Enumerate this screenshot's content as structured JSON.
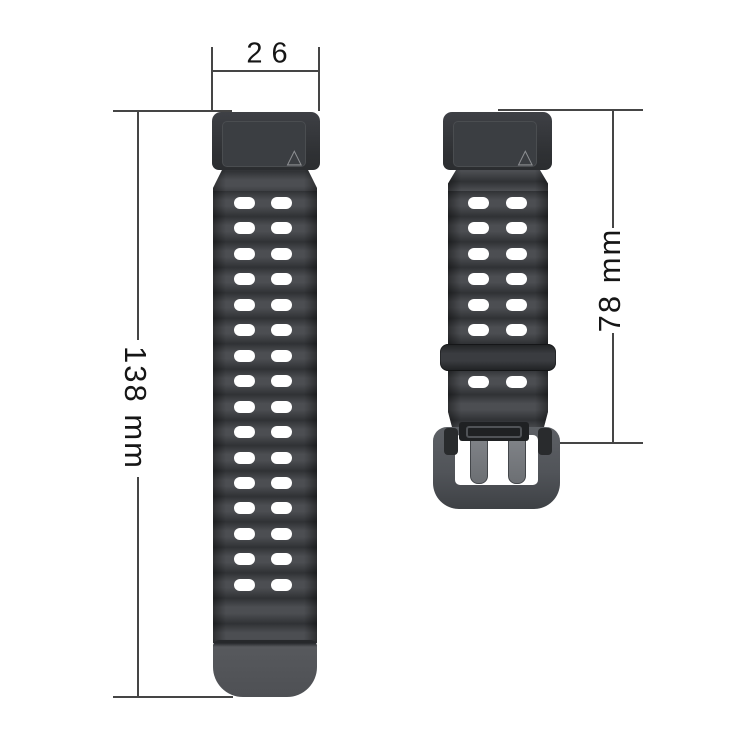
{
  "diagram": {
    "subject": "watch-strap-dimension-diagram",
    "dimensions": {
      "width": {
        "label": "26"
      },
      "long_strap_length": {
        "label": "138 mm"
      },
      "short_strap_length": {
        "label": "78 mm"
      }
    },
    "long_strap": {
      "hole_rows": 16,
      "hole_cols": 2
    },
    "short_strap": {
      "hole_rows_above_keeper": 6,
      "hole_rows_below_keeper": 1,
      "hole_cols": 2
    },
    "icons": {
      "triangle_mark": "△"
    },
    "colors": {
      "background": "#ffffff",
      "strap_ridge_dark": "#303235",
      "strap_ridge_light": "#4c4e52",
      "connector": "#323438",
      "strap_tip": "#515357",
      "keeper": "#2c2e31",
      "buckle_frame": "#54575c",
      "buckle_base": "#3e4145",
      "prong": "#75787c",
      "hole": "#ffffff",
      "dimension_line": "#454545",
      "label_text": "#161616"
    }
  }
}
